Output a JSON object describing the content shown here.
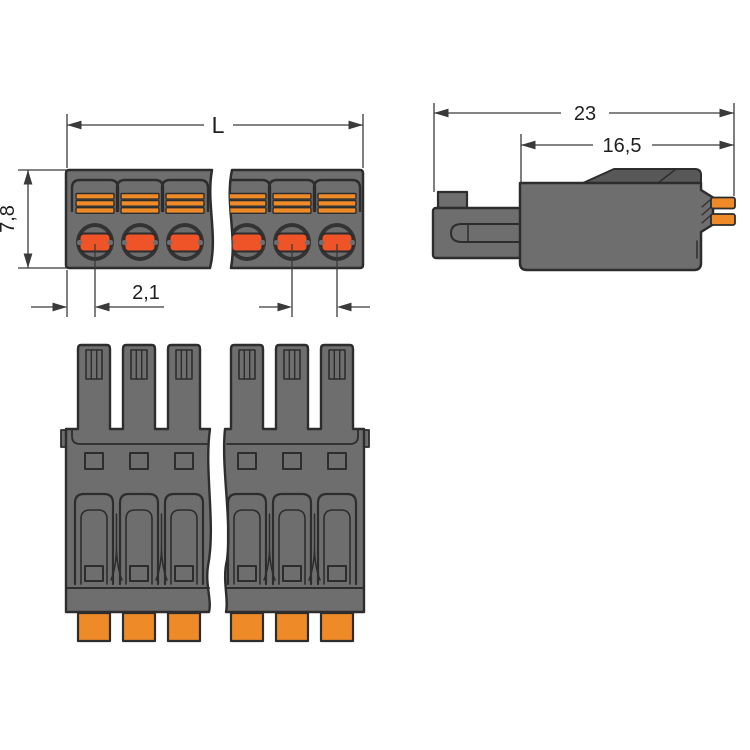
{
  "colors": {
    "background": "#ffffff",
    "housing_gray": "#6e6e6e",
    "housing_dark": "#585858",
    "ring_dark": "#333333",
    "outline": "#2d2d2d",
    "accent_orange": "#ef8a28",
    "clamp_red_orange": "#ee5427",
    "dimension_line": "#3a3a3a",
    "dimension_text": "#1f1f1f"
  },
  "views": {
    "top_view": {
      "dim_length": "L",
      "dim_height": "7,8",
      "dim_pitch": "2,1"
    },
    "side_view": {
      "dim_overall_depth": "23",
      "dim_housing_depth": "16,5"
    }
  }
}
